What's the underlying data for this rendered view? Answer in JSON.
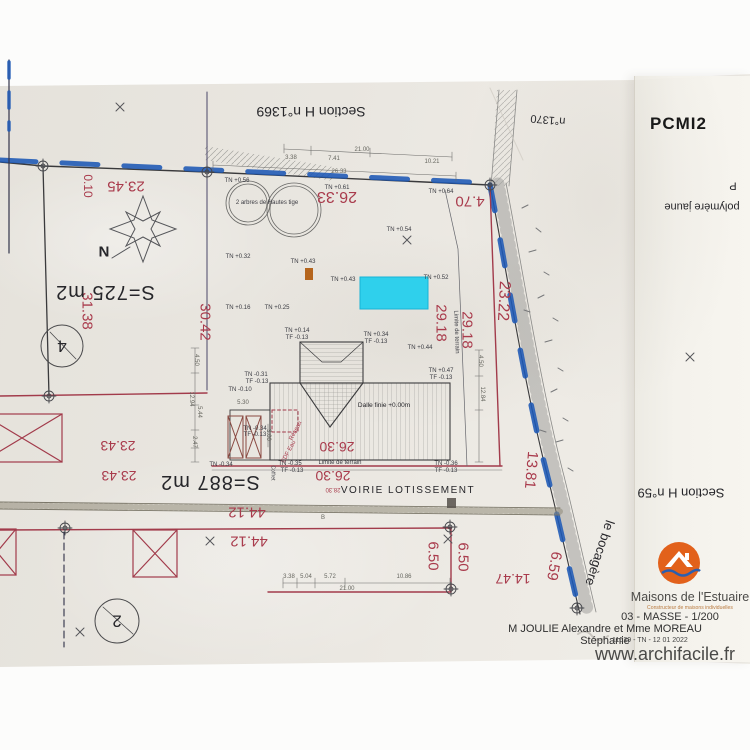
{
  "stamp": "PCMI2",
  "watermark": "www.archifacile.fr",
  "title_block": {
    "company": "Maisons de l'Estuaire",
    "tagline": "Constructeur de maisons individuelles",
    "sheet": "03 - MASSE - 1/200",
    "clients": "M JOULIE Alexandre et Mme MOREAU Stéphanie",
    "reference": "11529 - TN - 12 01 2022"
  },
  "colors": {
    "r": "#a93b4c",
    "k": "#26262a",
    "n": "#3a3b42",
    "g": "#66665f",
    "highlight_cyan": "#2fd0ec",
    "boundary_blue": "#1c58b5",
    "logo_orange": "#e2611b"
  },
  "annotations": [
    {
      "t": "0.10",
      "x": 88,
      "y": 186,
      "r": 90,
      "s": 12,
      "c": "r",
      "n": "dimension-label"
    },
    {
      "t": "23.45",
      "x": 126,
      "y": 186,
      "r": 180,
      "s": 15,
      "c": "r",
      "n": "dimension-label"
    },
    {
      "t": "26.33",
      "x": 337,
      "y": 196,
      "r": 180,
      "s": 16,
      "c": "r",
      "n": "dimension-label"
    },
    {
      "t": "4.70",
      "x": 470,
      "y": 201,
      "r": 180,
      "s": 15,
      "c": "r",
      "n": "dimension-label"
    },
    {
      "t": "31.38",
      "x": 87,
      "y": 311,
      "r": 90,
      "s": 15,
      "c": "r",
      "n": "dimension-label"
    },
    {
      "t": "30.42",
      "x": 205,
      "y": 322,
      "r": 90,
      "s": 15,
      "c": "r",
      "n": "dimension-label"
    },
    {
      "t": "29.18",
      "x": 441,
      "y": 323,
      "r": 90,
      "s": 15,
      "c": "r",
      "n": "dimension-label"
    },
    {
      "t": "29.18",
      "x": 467,
      "y": 330,
      "r": 90,
      "s": 15,
      "c": "r",
      "n": "dimension-label"
    },
    {
      "t": "23.22",
      "x": 503,
      "y": 301,
      "r": 93,
      "s": 16,
      "c": "r",
      "n": "dimension-label"
    },
    {
      "t": "13.81",
      "x": 531,
      "y": 470,
      "r": 95,
      "s": 15,
      "c": "r",
      "n": "dimension-label"
    },
    {
      "t": "23.43",
      "x": 118,
      "y": 446,
      "r": 180,
      "s": 14,
      "c": "r",
      "n": "dimension-label"
    },
    {
      "t": "23.43",
      "x": 119,
      "y": 476,
      "r": 180,
      "s": 14,
      "c": "r",
      "n": "dimension-label"
    },
    {
      "t": "26.30",
      "x": 337,
      "y": 447,
      "r": 180,
      "s": 14,
      "c": "r",
      "n": "dimension-label"
    },
    {
      "t": "26.30",
      "x": 333,
      "y": 476,
      "r": 180,
      "s": 14,
      "c": "r",
      "n": "dimension-label"
    },
    {
      "t": "28.30",
      "x": 333,
      "y": 489,
      "r": 180,
      "s": 6,
      "c": "r",
      "n": "dimension-label"
    },
    {
      "t": "44.12",
      "x": 247,
      "y": 512,
      "r": 180,
      "s": 15,
      "c": "r",
      "n": "dimension-label"
    },
    {
      "t": "44.12",
      "x": 249,
      "y": 541,
      "r": 180,
      "s": 15,
      "c": "r",
      "n": "dimension-label"
    },
    {
      "t": "6.50",
      "x": 433,
      "y": 556,
      "r": 90,
      "s": 15,
      "c": "r",
      "n": "dimension-label"
    },
    {
      "t": "6.50",
      "x": 463,
      "y": 557,
      "r": 90,
      "s": 15,
      "c": "r",
      "n": "dimension-label"
    },
    {
      "t": "14.47",
      "x": 513,
      "y": 579,
      "r": 180,
      "s": 14,
      "c": "r",
      "n": "dimension-label"
    },
    {
      "t": "6.59",
      "x": 554,
      "y": 566,
      "r": 100,
      "s": 15,
      "c": "r",
      "n": "dimension-label"
    },
    {
      "t": "EDF Eau",
      "x": 289,
      "y": 452,
      "r": -62,
      "s": 6,
      "c": "r",
      "n": "utility-label"
    },
    {
      "t": "Réseau",
      "x": 296,
      "y": 431,
      "r": -62,
      "s": 6,
      "c": "r",
      "n": "utility-label"
    },
    {
      "t": "S=725 m2",
      "x": 105,
      "y": 292,
      "r": 180,
      "s": 20,
      "c": "k",
      "n": "area-label",
      "ls": 1
    },
    {
      "t": "S=887 m2",
      "x": 210,
      "y": 482,
      "r": 180,
      "s": 20,
      "c": "k",
      "n": "area-label",
      "ls": 1
    },
    {
      "t": "Section H n°1369",
      "x": 311,
      "y": 112,
      "r": 180,
      "s": 14,
      "c": "k",
      "n": "parcel-section-label"
    },
    {
      "t": "n°1370",
      "x": 548,
      "y": 119,
      "r": 185,
      "s": 11,
      "c": "k",
      "n": "parcel-section-label"
    },
    {
      "t": "polymère jaune",
      "x": 702,
      "y": 206,
      "r": 180,
      "s": 11,
      "c": "k",
      "n": "material-note"
    },
    {
      "t": "P",
      "x": 733,
      "y": 185,
      "r": 180,
      "s": 11,
      "c": "k",
      "n": "material-note"
    },
    {
      "t": "Section H n°59",
      "x": 681,
      "y": 493,
      "r": 180,
      "s": 13,
      "c": "k",
      "n": "parcel-section-label"
    },
    {
      "t": "le bocagère",
      "x": 600,
      "y": 553,
      "r": 108,
      "s": 13,
      "c": "k",
      "n": "street-name-label"
    },
    {
      "t": "VOIRIE LOTISSEMENT",
      "x": 408,
      "y": 491,
      "r": 0,
      "s": 10,
      "c": "k",
      "n": "road-label",
      "ls": 1.5
    },
    {
      "t": "Dalle finie +0.00m",
      "x": 384,
      "y": 406,
      "r": 0,
      "s": 6.5,
      "c": "k",
      "n": "slab-level-label"
    },
    {
      "t": "2 arbres de Hautes tige",
      "x": 267,
      "y": 203,
      "r": 0,
      "s": 6,
      "c": "n",
      "n": "tree-note"
    },
    {
      "t": "Limite de terrain",
      "x": 340,
      "y": 463,
      "r": 0,
      "s": 6,
      "c": "n",
      "n": "boundary-note"
    },
    {
      "t": "Limite de terrain",
      "x": 456,
      "y": 332,
      "r": 88,
      "s": 6,
      "c": "n",
      "n": "boundary-note"
    },
    {
      "t": "N",
      "x": 104,
      "y": 251,
      "r": 180,
      "s": 15,
      "c": "k",
      "w": 700,
      "n": "north-label"
    },
    {
      "t": "4",
      "x": 62,
      "y": 346,
      "r": 180,
      "s": 17,
      "c": "k",
      "n": "lot-number"
    },
    {
      "t": "2",
      "x": 117,
      "y": 621,
      "r": 180,
      "s": 17,
      "c": "k",
      "n": "lot-number"
    },
    {
      "t": "TN +0.56",
      "x": 237,
      "y": 181,
      "r": 0,
      "s": 6,
      "c": "n",
      "n": "level-label"
    },
    {
      "t": "TN +0.61",
      "x": 337,
      "y": 188,
      "r": 0,
      "s": 6,
      "c": "n",
      "n": "level-label"
    },
    {
      "t": "TN +0.64",
      "x": 441,
      "y": 192,
      "r": 0,
      "s": 6,
      "c": "n",
      "n": "level-label"
    },
    {
      "t": "TN +0.54",
      "x": 399,
      "y": 230,
      "r": 0,
      "s": 6,
      "c": "n",
      "n": "level-label"
    },
    {
      "t": "TN +0.32",
      "x": 238,
      "y": 257,
      "r": 0,
      "s": 6,
      "c": "n",
      "n": "level-label"
    },
    {
      "t": "TN +0.43",
      "x": 303,
      "y": 262,
      "r": 0,
      "s": 6,
      "c": "n",
      "n": "level-label"
    },
    {
      "t": "TN +0.43",
      "x": 343,
      "y": 280,
      "r": 0,
      "s": 6,
      "c": "n",
      "n": "level-label"
    },
    {
      "t": "TN +0.52",
      "x": 436,
      "y": 278,
      "r": 0,
      "s": 6,
      "c": "n",
      "n": "level-label"
    },
    {
      "t": "TN +0.16",
      "x": 238,
      "y": 308,
      "r": 0,
      "s": 6,
      "c": "n",
      "n": "level-label"
    },
    {
      "t": "TN +0.25",
      "x": 277,
      "y": 308,
      "r": 0,
      "s": 6,
      "c": "n",
      "n": "level-label"
    },
    {
      "t": "TN +0.14",
      "x": 297,
      "y": 331,
      "r": 0,
      "s": 6,
      "c": "n",
      "n": "level-label"
    },
    {
      "t": "TF -0.13",
      "x": 297,
      "y": 338,
      "r": 0,
      "s": 6,
      "c": "n",
      "n": "level-label"
    },
    {
      "t": "TN +0.34",
      "x": 376,
      "y": 335,
      "r": 0,
      "s": 6,
      "c": "n",
      "n": "level-label"
    },
    {
      "t": "TF -0.13",
      "x": 376,
      "y": 342,
      "r": 0,
      "s": 6,
      "c": "n",
      "n": "level-label"
    },
    {
      "t": "TN +0.44",
      "x": 420,
      "y": 348,
      "r": 0,
      "s": 6,
      "c": "n",
      "n": "level-label"
    },
    {
      "t": "TN +0.47",
      "x": 441,
      "y": 371,
      "r": 0,
      "s": 6,
      "c": "n",
      "n": "level-label"
    },
    {
      "t": "TF -0.13",
      "x": 441,
      "y": 378,
      "r": 0,
      "s": 6,
      "c": "n",
      "n": "level-label"
    },
    {
      "t": "TN -0.31",
      "x": 256,
      "y": 375,
      "r": 0,
      "s": 6,
      "c": "n",
      "n": "level-label"
    },
    {
      "t": "TF -0.13",
      "x": 257,
      "y": 382,
      "r": 0,
      "s": 6,
      "c": "n",
      "n": "level-label"
    },
    {
      "t": "TN -0.10",
      "x": 240,
      "y": 390,
      "r": 0,
      "s": 6,
      "c": "n",
      "n": "level-label"
    },
    {
      "t": "TN -0.34",
      "x": 255,
      "y": 429,
      "r": 0,
      "s": 6,
      "c": "n",
      "n": "level-label"
    },
    {
      "t": "TF -0.13",
      "x": 255,
      "y": 435,
      "r": 0,
      "s": 6,
      "c": "n",
      "n": "level-label"
    },
    {
      "t": "TN -0.34",
      "x": 221,
      "y": 465,
      "r": 0,
      "s": 6,
      "c": "n",
      "n": "level-label"
    },
    {
      "t": "TN -0.35",
      "x": 290,
      "y": 464,
      "r": 0,
      "s": 6,
      "c": "n",
      "n": "level-label"
    },
    {
      "t": "TF -0.13",
      "x": 292,
      "y": 471,
      "r": 0,
      "s": 6,
      "c": "n",
      "n": "level-label"
    },
    {
      "t": "TN -0.36",
      "x": 446,
      "y": 464,
      "r": 0,
      "s": 6,
      "c": "n",
      "n": "level-label"
    },
    {
      "t": "TF -0.13",
      "x": 446,
      "y": 471,
      "r": 0,
      "s": 6,
      "c": "n",
      "n": "level-label"
    },
    {
      "t": "21.00",
      "x": 362,
      "y": 150,
      "r": 0,
      "s": 6,
      "c": "g",
      "n": "dimension-chain-label"
    },
    {
      "t": "3.38",
      "x": 291,
      "y": 158,
      "r": 0,
      "s": 6,
      "c": "g",
      "n": "dimension-chain-label"
    },
    {
      "t": "7.41",
      "x": 334,
      "y": 159,
      "r": 0,
      "s": 6,
      "c": "g",
      "n": "dimension-chain-label"
    },
    {
      "t": "10.21",
      "x": 432,
      "y": 162,
      "r": 0,
      "s": 6,
      "c": "g",
      "n": "dimension-chain-label"
    },
    {
      "t": "26.33",
      "x": 339,
      "y": 172,
      "r": 0,
      "s": 6,
      "c": "g",
      "n": "dimension-chain-label"
    },
    {
      "t": "5.30",
      "x": 243,
      "y": 403,
      "r": 0,
      "s": 6,
      "c": "g",
      "n": "dimension-chain-label"
    },
    {
      "t": "3.00",
      "x": 268,
      "y": 435,
      "r": 90,
      "s": 6,
      "c": "g",
      "n": "dimension-chain-label"
    },
    {
      "t": "4.50",
      "x": 196,
      "y": 360,
      "r": 90,
      "s": 6,
      "c": "g",
      "n": "dimension-chain-label"
    },
    {
      "t": "12.94",
      "x": 191,
      "y": 399,
      "r": 90,
      "s": 6,
      "c": "g",
      "n": "dimension-chain-label"
    },
    {
      "t": "5.44",
      "x": 199,
      "y": 412,
      "r": 90,
      "s": 6,
      "c": "g",
      "n": "dimension-chain-label"
    },
    {
      "t": "2.47",
      "x": 194,
      "y": 442,
      "r": 90,
      "s": 6,
      "c": "g",
      "n": "dimension-chain-label"
    },
    {
      "t": "4.50",
      "x": 480,
      "y": 361,
      "r": 90,
      "s": 6,
      "c": "g",
      "n": "dimension-chain-label"
    },
    {
      "t": "12.84",
      "x": 482,
      "y": 394,
      "r": 90,
      "s": 6,
      "c": "g",
      "n": "dimension-chain-label"
    },
    {
      "t": "3.38",
      "x": 289,
      "y": 577,
      "r": 0,
      "s": 6,
      "c": "g",
      "n": "dimension-chain-label"
    },
    {
      "t": "5.04",
      "x": 306,
      "y": 577,
      "r": 0,
      "s": 6,
      "c": "g",
      "n": "dimension-chain-label"
    },
    {
      "t": "5.72",
      "x": 330,
      "y": 577,
      "r": 0,
      "s": 6,
      "c": "g",
      "n": "dimension-chain-label"
    },
    {
      "t": "10.86",
      "x": 404,
      "y": 577,
      "r": 0,
      "s": 6,
      "c": "g",
      "n": "dimension-chain-label"
    },
    {
      "t": "21.00",
      "x": 347,
      "y": 589,
      "r": 0,
      "s": 6,
      "c": "g",
      "n": "dimension-chain-label"
    },
    {
      "t": "B",
      "x": 323,
      "y": 518,
      "r": 0,
      "s": 6,
      "c": "g",
      "n": "road-point-label"
    },
    {
      "t": "Coffret",
      "x": 272,
      "y": 473,
      "r": 90,
      "s": 5,
      "c": "n",
      "n": "utility-label"
    }
  ]
}
